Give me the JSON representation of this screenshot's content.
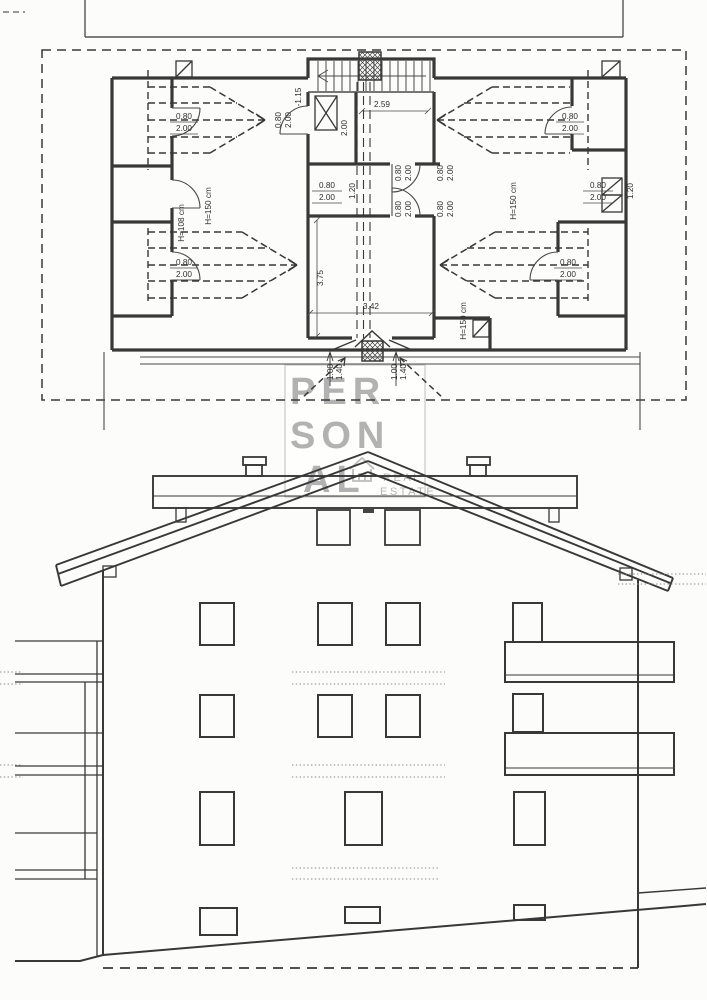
{
  "watermark": {
    "l1": "PER",
    "l2": "SON",
    "l3": "AL",
    "r1": "REAL",
    "r2": "ESTATE",
    "letter_color": "#b2b2b2",
    "border_color": "#c9c9c9"
  },
  "plan": {
    "level": "-1.15",
    "w259": "2.59",
    "w200": "2.00",
    "w120": "1.20",
    "w375": "3.75",
    "w342": "3.42",
    "w100": "1.00",
    "w140": "1.40",
    "door_w": "0.80",
    "door_h": "2.00",
    "h150": "H=150 cm",
    "h108": "H=108 cm"
  },
  "colors": {
    "line": "#383838",
    "dotted": "#8a8a8a",
    "paper": "#fcfcfb"
  }
}
